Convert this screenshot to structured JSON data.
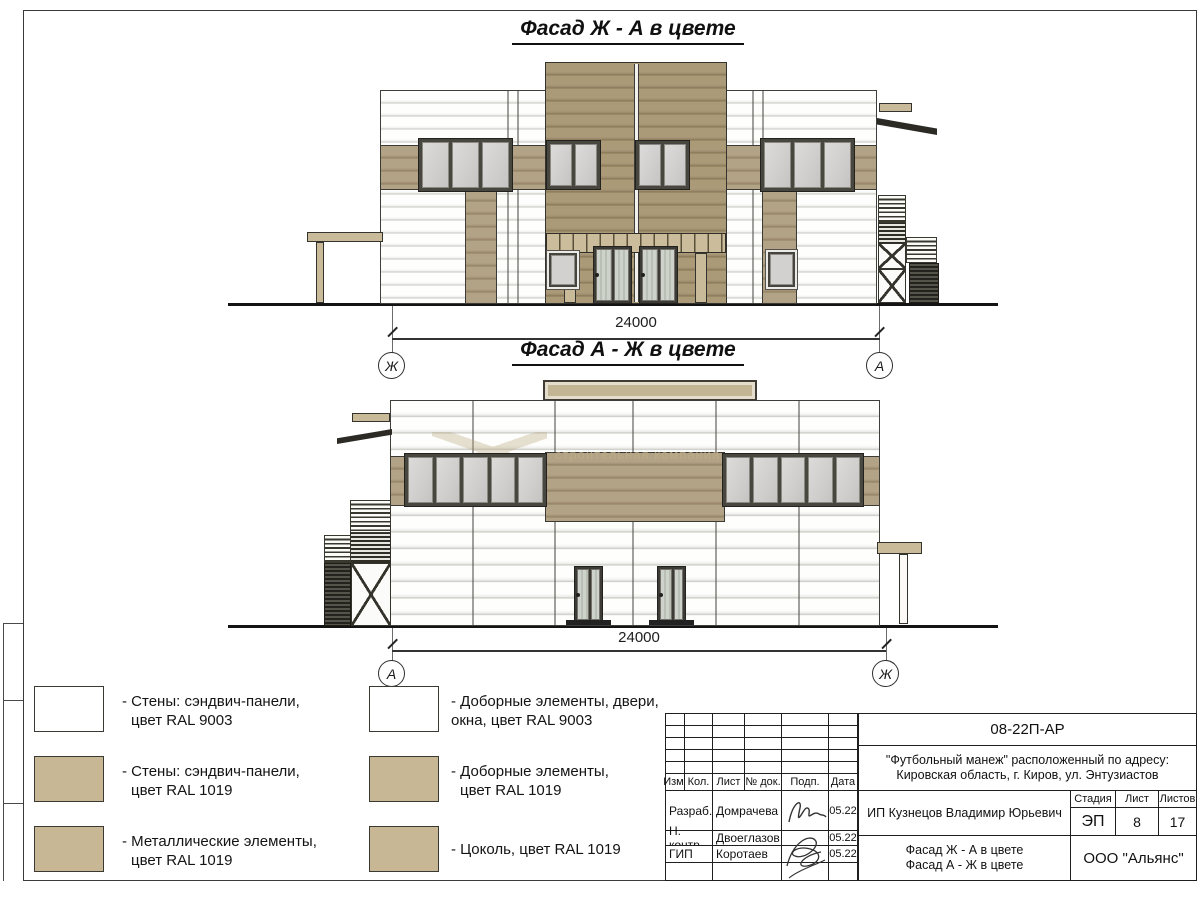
{
  "drawing": {
    "facade_top": {
      "title": "Фасад Ж - А в цвете",
      "dimension": "24000",
      "axis_left": "Ж",
      "axis_right": "А"
    },
    "facade_bottom": {
      "title": "Фасад А - Ж в цвете",
      "dimension": "24000",
      "axis_left": "А",
      "axis_right": "Ж",
      "watermark": "строительная компания"
    },
    "legend": {
      "items": [
        {
          "swatch_color": "#ffffff",
          "line1": "- Стены: сэндвич-панели,",
          "line2": "цвет RAL 9003"
        },
        {
          "swatch_color": "#c8b795",
          "line1": "- Стены: сэндвич-панели,",
          "line2": "цвет RAL 1019"
        },
        {
          "swatch_color": "#c8b795",
          "line1": "- Металлические элементы,",
          "line2": "цвет RAL 1019"
        },
        {
          "swatch_color": "#ffffff",
          "line1": "- Доборные элементы, двери,",
          "line2": "окна, цвет RAL 9003"
        },
        {
          "swatch_color": "#c8b795",
          "line1": "- Доборные элементы,",
          "line2": "цвет RAL 1019"
        },
        {
          "swatch_color": "#c8b795",
          "line1": "- Цоколь, цвет RAL 1019",
          "line2": ""
        }
      ]
    },
    "title_block": {
      "doc_number": "08-22П-АР",
      "project_name_line1": "\"Футбольный манеж\" расположенный по адресу:",
      "project_name_line2": "Кировская область, г. Киров, ул. Энтузиастов",
      "client": "ИП Кузнецов Владимир Юрьевич",
      "drawing_title_line1": "Фасад Ж - А в цвете",
      "drawing_title_line2": "Фасад А - Ж в цвете",
      "company": "ООО \"Альянс\"",
      "header_cols": {
        "izm": "Изм.",
        "kol": "Кол.",
        "list": "Лист",
        "doc_no": "№ док.",
        "podp": "Подп.",
        "date": "Дата"
      },
      "stage_label": "Стадия",
      "sheet_label": "Лист",
      "sheets_label": "Листов",
      "stage": "ЭП",
      "sheet_number": "8",
      "sheets_total": "17",
      "signers": [
        {
          "role": "Разраб.",
          "name": "Домрачева",
          "date": "05.22"
        },
        {
          "role": "Н. контр.",
          "name": "Двоеглазов",
          "date": "05.22"
        },
        {
          "role": "ГИП",
          "name": "Коротаев",
          "date": "05.22"
        }
      ]
    },
    "colors": {
      "ral_1019_facade": "#ab9b7e",
      "ral_1019_legend": "#c8b795",
      "ral_9003": "#ffffff",
      "window_glass": "#d6d4d2",
      "line": "#2f2f2b"
    }
  }
}
